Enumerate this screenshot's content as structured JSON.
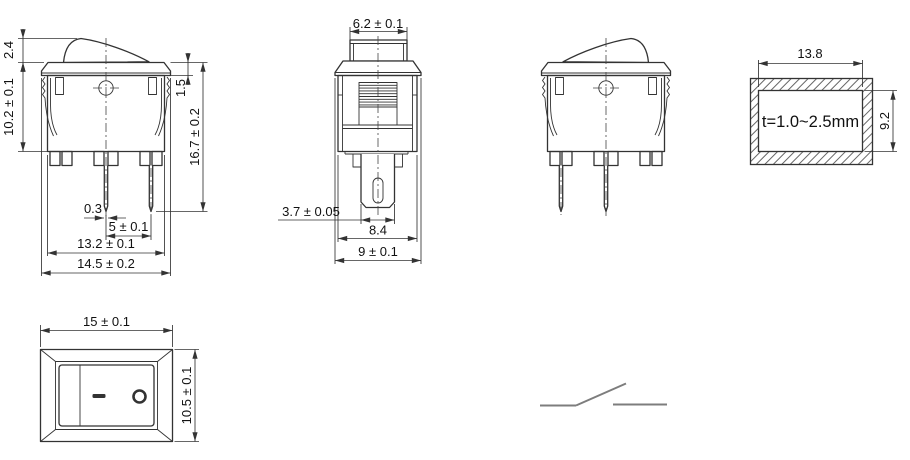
{
  "drawing": {
    "front_view": {
      "rocker_height": "2.4",
      "body_height": "10.2 ± 0.1",
      "flange_thickness": "1.5",
      "total_height": "16.7 ± 0.2",
      "pin_thickness": "0.3",
      "pin_pitch": "5 ± 0.1",
      "body_width": "13.2 ± 0.1",
      "flange_width": "14.5 ± 0.2"
    },
    "side_view": {
      "actuator_width": "6.2 ± 0.1",
      "terminal_width": "3.7 ± 0.05",
      "body_depth": "8.4",
      "flange_depth": "9 ± 0.1"
    },
    "panel_cutout": {
      "width": "13.8",
      "height": "9.2",
      "panel_thickness_note": "t=1.0~2.5mm"
    },
    "top_view": {
      "width": "15 ± 0.1",
      "height": "10.5 ± 0.1",
      "on_symbol": "−",
      "off_symbol": "O"
    }
  }
}
